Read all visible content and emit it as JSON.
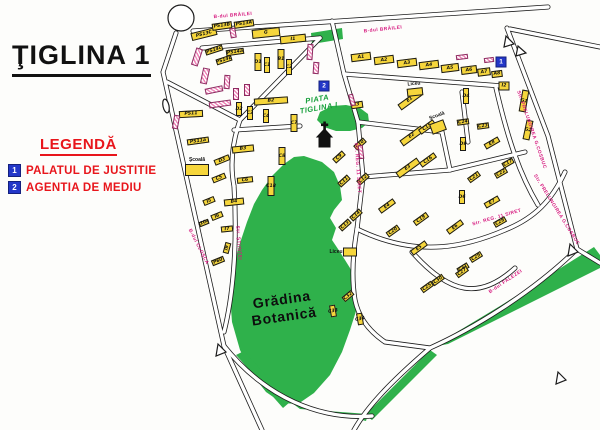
{
  "title": "ŢIGLINA 1",
  "legend": {
    "heading": "LEGENDĂ",
    "items": [
      {
        "num": "1",
        "label": "PALATUL DE JUSTITIE"
      },
      {
        "num": "2",
        "label": "AGENTIA DE MEDIU"
      }
    ],
    "marker_color": "#2337c8",
    "text_color": "#e8151b"
  },
  "map": {
    "colors": {
      "building_yellow": "#f6d63c",
      "building_pink": "#ef86b8",
      "green_area": "#2fb14b",
      "street_name": "#d6187e",
      "road_line": "#1c1c1c"
    },
    "streets": [
      {
        "name": "B-dul BRĂILEI",
        "x": 233,
        "y": 16,
        "a": -5
      },
      {
        "name": "B-dul BRĂILEI",
        "x": 383,
        "y": 30,
        "a": -6
      },
      {
        "name": "B-dul CLOŞCA",
        "x": 198,
        "y": 247,
        "a": 63
      },
      {
        "name": "Str. ŞTIINŢEI",
        "x": 238,
        "y": 243,
        "a": 86
      },
      {
        "name": "Str. REG. 11 SIRET",
        "x": 357,
        "y": 168,
        "a": 86
      },
      {
        "name": "Str. REG. 11 SIRET",
        "x": 497,
        "y": 218,
        "a": -16
      },
      {
        "name": "Str. PRELUNGIREA G.COSBUC",
        "x": 531,
        "y": 130,
        "a": 71
      },
      {
        "name": "Str. PRELUNGIREA G.COSBUC",
        "x": 556,
        "y": 210,
        "a": 58
      },
      {
        "name": "B-dul FALEZEI",
        "x": 506,
        "y": 282,
        "a": -34
      }
    ],
    "markers": [
      {
        "num": "1",
        "x": 501,
        "y": 62
      },
      {
        "num": "2",
        "x": 324,
        "y": 86
      }
    ],
    "landmarks": [
      {
        "kind": "piata",
        "lines": [
          "PIATA",
          "TIGLINA I"
        ],
        "x": 318,
        "y": 104,
        "a": -10
      },
      {
        "kind": "garden",
        "lines": [
          "Grădina",
          "Botanică"
        ],
        "x": 283,
        "y": 308,
        "a": -8
      },
      {
        "kind": "place",
        "lines": [
          "Şcoală"
        ],
        "x": 197,
        "y": 160,
        "a": 0
      },
      {
        "kind": "place",
        "lines": [
          "Şcoală"
        ],
        "x": 437,
        "y": 116,
        "a": -20
      },
      {
        "kind": "place",
        "lines": [
          "Liceu"
        ],
        "x": 414,
        "y": 84,
        "a": -5
      },
      {
        "kind": "place",
        "lines": [
          "Liceu"
        ],
        "x": 336,
        "y": 252,
        "a": 0
      }
    ],
    "buildings": [
      {
        "label": "PS13C",
        "x": 204,
        "y": 34,
        "w": 26,
        "h": 8,
        "a": -14
      },
      {
        "label": "PS13B",
        "x": 222,
        "y": 26,
        "w": 20,
        "h": 7,
        "a": -8
      },
      {
        "label": "PS13A",
        "x": 244,
        "y": 24,
        "w": 20,
        "h": 7,
        "a": -8
      },
      {
        "label": "G",
        "x": 266,
        "y": 33,
        "w": 28,
        "h": 9,
        "a": -6
      },
      {
        "label": "I1",
        "x": 293,
        "y": 39,
        "w": 26,
        "h": 8,
        "a": -6
      },
      {
        "label": "A1",
        "x": 361,
        "y": 57,
        "w": 20,
        "h": 8,
        "a": -7
      },
      {
        "label": "A2",
        "x": 384,
        "y": 60,
        "w": 20,
        "h": 8,
        "a": -7
      },
      {
        "label": "A3",
        "x": 407,
        "y": 63,
        "w": 20,
        "h": 8,
        "a": -7
      },
      {
        "label": "A4",
        "x": 429,
        "y": 65,
        "w": 20,
        "h": 8,
        "a": -7
      },
      {
        "label": "A5",
        "x": 450,
        "y": 68,
        "w": 18,
        "h": 8,
        "a": -7
      },
      {
        "label": "A6",
        "x": 469,
        "y": 70,
        "w": 16,
        "h": 8,
        "a": -7
      },
      {
        "label": "A7",
        "x": 484,
        "y": 72,
        "w": 13,
        "h": 8,
        "a": -7
      },
      {
        "label": "A8",
        "x": 497,
        "y": 74,
        "w": 11,
        "h": 7,
        "a": -7
      },
      {
        "label": "I2",
        "x": 504,
        "y": 86,
        "w": 11,
        "h": 9,
        "a": 0
      },
      {
        "label": "PS14c",
        "x": 214,
        "y": 50,
        "w": 18,
        "h": 6,
        "a": -18
      },
      {
        "label": "PS14a",
        "x": 235,
        "y": 52,
        "w": 18,
        "h": 6,
        "a": -8
      },
      {
        "label": "PS14b",
        "x": 224,
        "y": 60,
        "w": 16,
        "h": 6,
        "a": -18
      },
      {
        "label": "PS11",
        "x": 191,
        "y": 114,
        "w": 24,
        "h": 7,
        "a": -3
      },
      {
        "label": "PS11a",
        "x": 198,
        "y": 141,
        "w": 22,
        "h": 6,
        "a": -8
      },
      {
        "label": "",
        "x": 197,
        "y": 170,
        "w": 24,
        "h": 12,
        "a": 0
      },
      {
        "label": "D1",
        "x": 258,
        "y": 62,
        "w": 7,
        "h": 18,
        "a": 0
      },
      {
        "label": "C1",
        "x": 267,
        "y": 65,
        "w": 6,
        "h": 16,
        "a": 0
      },
      {
        "label": "B1",
        "x": 281,
        "y": 59,
        "w": 7,
        "h": 20,
        "a": 0
      },
      {
        "label": "C2",
        "x": 289,
        "y": 67,
        "w": 6,
        "h": 16,
        "a": 0
      },
      {
        "label": "B2",
        "x": 271,
        "y": 101,
        "w": 34,
        "h": 7,
        "a": -4
      },
      {
        "label": "D2",
        "x": 239,
        "y": 109,
        "w": 6,
        "h": 14,
        "a": 0
      },
      {
        "label": "C3",
        "x": 250,
        "y": 113,
        "w": 6,
        "h": 14,
        "a": 0
      },
      {
        "label": "C4",
        "x": 266,
        "y": 116,
        "w": 6,
        "h": 14,
        "a": 0
      },
      {
        "label": "B3",
        "x": 243,
        "y": 149,
        "w": 22,
        "h": 7,
        "a": -6
      },
      {
        "label": "D3",
        "x": 222,
        "y": 160,
        "w": 16,
        "h": 6,
        "a": -22
      },
      {
        "label": "C5",
        "x": 219,
        "y": 178,
        "w": 14,
        "h": 6,
        "a": -22
      },
      {
        "label": "C6",
        "x": 245,
        "y": 180,
        "w": 16,
        "h": 6,
        "a": -6
      },
      {
        "label": "I5",
        "x": 209,
        "y": 201,
        "w": 12,
        "h": 6,
        "a": -22
      },
      {
        "label": "B4",
        "x": 234,
        "y": 202,
        "w": 20,
        "h": 7,
        "a": -6
      },
      {
        "label": "I6",
        "x": 217,
        "y": 216,
        "w": 12,
        "h": 6,
        "a": -22
      },
      {
        "label": "I10a",
        "x": 204,
        "y": 223,
        "w": 10,
        "h": 5,
        "a": -22
      },
      {
        "label": "I7",
        "x": 227,
        "y": 229,
        "w": 12,
        "h": 6,
        "a": -6
      },
      {
        "label": "I9",
        "x": 227,
        "y": 248,
        "w": 11,
        "h": 6,
        "a": -75
      },
      {
        "label": "P60",
        "x": 218,
        "y": 261,
        "w": 13,
        "h": 6,
        "a": -22
      },
      {
        "label": "C7",
        "x": 294,
        "y": 123,
        "w": 7,
        "h": 18,
        "a": 0
      },
      {
        "label": "C8",
        "x": 282,
        "y": 156,
        "w": 7,
        "h": 18,
        "a": 0
      },
      {
        "label": "C18",
        "x": 271,
        "y": 186,
        "w": 7,
        "h": 20,
        "a": 0
      },
      {
        "label": "I3",
        "x": 357,
        "y": 105,
        "w": 12,
        "h": 7,
        "a": -8
      },
      {
        "label": "C9",
        "x": 339,
        "y": 157,
        "w": 13,
        "h": 6,
        "a": -42
      },
      {
        "label": "C10",
        "x": 360,
        "y": 144,
        "w": 13,
        "h": 6,
        "a": -42
      },
      {
        "label": "C11",
        "x": 344,
        "y": 181,
        "w": 13,
        "h": 6,
        "a": -42
      },
      {
        "label": "C12",
        "x": 363,
        "y": 179,
        "w": 13,
        "h": 6,
        "a": -42
      },
      {
        "label": "C14",
        "x": 356,
        "y": 215,
        "w": 13,
        "h": 6,
        "a": -42
      },
      {
        "label": "C13",
        "x": 345,
        "y": 225,
        "w": 13,
        "h": 6,
        "a": -42
      },
      {
        "label": "",
        "x": 350,
        "y": 252,
        "w": 14,
        "h": 9,
        "a": 0
      },
      {
        "label": "E1",
        "x": 410,
        "y": 100,
        "w": 26,
        "h": 7,
        "a": -36
      },
      {
        "label": "E2",
        "x": 412,
        "y": 136,
        "w": 26,
        "h": 7,
        "a": -36
      },
      {
        "label": "C15",
        "x": 427,
        "y": 127,
        "w": 18,
        "h": 6,
        "a": -36
      },
      {
        "label": "E3",
        "x": 408,
        "y": 168,
        "w": 26,
        "h": 7,
        "a": -36
      },
      {
        "label": "C16",
        "x": 428,
        "y": 160,
        "w": 18,
        "h": 6,
        "a": -36
      },
      {
        "label": "",
        "x": 438,
        "y": 127,
        "w": 15,
        "h": 11,
        "a": -20
      },
      {
        "label": "",
        "x": 415,
        "y": 92,
        "w": 16,
        "h": 8,
        "a": -6
      },
      {
        "label": "E4",
        "x": 387,
        "y": 206,
        "w": 18,
        "h": 6,
        "a": -36
      },
      {
        "label": "C19",
        "x": 421,
        "y": 219,
        "w": 16,
        "h": 6,
        "a": -36
      },
      {
        "label": "C20",
        "x": 393,
        "y": 231,
        "w": 14,
        "h": 6,
        "a": -36
      },
      {
        "label": "E5",
        "x": 419,
        "y": 248,
        "w": 18,
        "h": 6,
        "a": -36
      },
      {
        "label": "E6",
        "x": 455,
        "y": 227,
        "w": 18,
        "h": 6,
        "a": -36
      },
      {
        "label": "E7",
        "x": 492,
        "y": 202,
        "w": 16,
        "h": 6,
        "a": -30
      },
      {
        "label": "D6",
        "x": 462,
        "y": 197,
        "w": 6,
        "h": 14,
        "a": 0
      },
      {
        "label": "C21",
        "x": 474,
        "y": 177,
        "w": 13,
        "h": 6,
        "a": -36
      },
      {
        "label": "C22",
        "x": 501,
        "y": 173,
        "w": 13,
        "h": 6,
        "a": -30
      },
      {
        "label": "C17",
        "x": 508,
        "y": 163,
        "w": 12,
        "h": 6,
        "a": -30
      },
      {
        "label": "E8",
        "x": 492,
        "y": 143,
        "w": 16,
        "h": 6,
        "a": -30
      },
      {
        "label": "D9",
        "x": 463,
        "y": 144,
        "w": 6,
        "h": 14,
        "a": 0
      },
      {
        "label": "C23",
        "x": 483,
        "y": 126,
        "w": 12,
        "h": 6,
        "a": -8
      },
      {
        "label": "C24",
        "x": 463,
        "y": 122,
        "w": 12,
        "h": 6,
        "a": -8
      },
      {
        "label": "D4",
        "x": 466,
        "y": 96,
        "w": 6,
        "h": 16,
        "a": 0
      },
      {
        "label": "G1",
        "x": 524,
        "y": 101,
        "w": 7,
        "h": 22,
        "a": 10
      },
      {
        "label": "G2",
        "x": 528,
        "y": 130,
        "w": 7,
        "h": 20,
        "a": 12
      },
      {
        "label": "C28",
        "x": 500,
        "y": 222,
        "w": 13,
        "h": 6,
        "a": -30
      },
      {
        "label": "C29",
        "x": 476,
        "y": 257,
        "w": 13,
        "h": 6,
        "a": -32
      },
      {
        "label": "C31",
        "x": 463,
        "y": 268,
        "w": 12,
        "h": 6,
        "a": -32
      },
      {
        "label": "C25",
        "x": 427,
        "y": 287,
        "w": 13,
        "h": 6,
        "a": -36
      },
      {
        "label": "C27",
        "x": 462,
        "y": 272,
        "w": 13,
        "h": 6,
        "a": -36
      },
      {
        "label": "C30",
        "x": 438,
        "y": 280,
        "w": 13,
        "h": 6,
        "a": -36
      },
      {
        "label": "C32",
        "x": 348,
        "y": 296,
        "w": 12,
        "h": 6,
        "a": -40
      },
      {
        "label": "C33",
        "x": 333,
        "y": 311,
        "w": 6,
        "h": 12,
        "a": -10
      },
      {
        "label": "C34",
        "x": 360,
        "y": 319,
        "w": 6,
        "h": 12,
        "a": -10
      }
    ],
    "pink_blocks": [
      {
        "x": 197,
        "y": 57,
        "w": 7,
        "h": 18,
        "a": 18
      },
      {
        "x": 205,
        "y": 76,
        "w": 7,
        "h": 16,
        "a": 12
      },
      {
        "x": 214,
        "y": 90,
        "w": 18,
        "h": 6,
        "a": -12
      },
      {
        "x": 227,
        "y": 82,
        "w": 6,
        "h": 14,
        "a": 4
      },
      {
        "x": 236,
        "y": 94,
        "w": 6,
        "h": 12,
        "a": 0
      },
      {
        "x": 220,
        "y": 104,
        "w": 22,
        "h": 6,
        "a": -8
      },
      {
        "x": 247,
        "y": 90,
        "w": 6,
        "h": 12,
        "a": 0
      },
      {
        "x": 233,
        "y": 33,
        "w": 6,
        "h": 10,
        "a": -10
      },
      {
        "x": 176,
        "y": 122,
        "w": 6,
        "h": 14,
        "a": 10
      },
      {
        "x": 310,
        "y": 52,
        "w": 6,
        "h": 16,
        "a": 4
      },
      {
        "x": 316,
        "y": 68,
        "w": 6,
        "h": 12,
        "a": 4
      },
      {
        "x": 352,
        "y": 100,
        "w": 5,
        "h": 12,
        "a": -15
      },
      {
        "x": 361,
        "y": 152,
        "w": 5,
        "h": 14,
        "a": -7
      },
      {
        "x": 462,
        "y": 57,
        "w": 12,
        "h": 5,
        "a": -7
      },
      {
        "x": 489,
        "y": 60,
        "w": 10,
        "h": 5,
        "a": -7
      }
    ]
  }
}
